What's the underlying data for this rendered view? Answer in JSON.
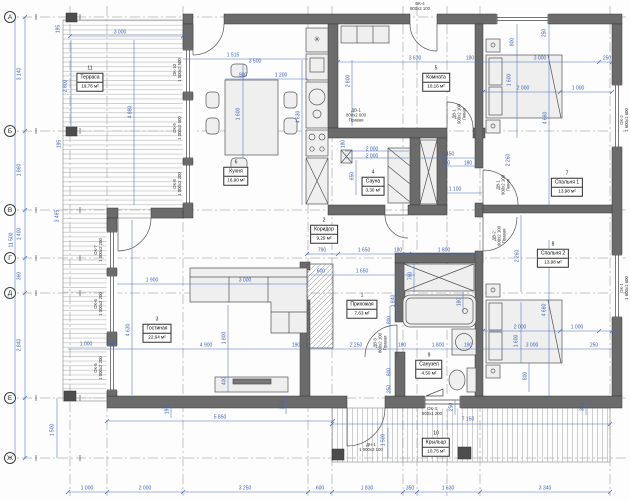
{
  "drawing_title": "План этажа",
  "axes": [
    {
      "label": "А",
      "y": 17
    },
    {
      "label": "Б",
      "y": 131
    },
    {
      "label": "В",
      "y": 210
    },
    {
      "label": "Г",
      "y": 258
    },
    {
      "label": "Д",
      "y": 293
    },
    {
      "label": "Е",
      "y": 398
    },
    {
      "label": "Ж",
      "y": 458
    }
  ],
  "rooms": [
    {
      "num": "11",
      "name": "Терраса",
      "area": "19,76 м²",
      "x": 90,
      "y": 80
    },
    {
      "num": "6",
      "name": "Кухня",
      "area": "16,90 м²",
      "x": 236,
      "y": 174
    },
    {
      "num": "5",
      "name": "Комната",
      "area": "10,16 м²",
      "x": 436,
      "y": 80
    },
    {
      "num": "4",
      "name": "Сауна",
      "area": "3,30 м²",
      "x": 373,
      "y": 184
    },
    {
      "num": "2",
      "name": "Коридор",
      "area": "9,29 м²",
      "x": 324,
      "y": 232
    },
    {
      "num": "1",
      "name": "Прихожая",
      "area": "7,63 м²",
      "x": 362,
      "y": 307
    },
    {
      "num": "3",
      "name": "Гостиная",
      "area": "22,64 м²",
      "x": 157,
      "y": 331
    },
    {
      "num": "9",
      "name": "Санузел",
      "area": "4,50 м²",
      "x": 429,
      "y": 367
    },
    {
      "num": "7",
      "name": "Спальня 1",
      "area": "13,98 м²",
      "x": 567,
      "y": 185
    },
    {
      "num": "8",
      "name": "Спальня 2",
      "area": "13,98 м²",
      "x": 553,
      "y": 256
    },
    {
      "num": "10",
      "name": "Крыльцо",
      "area": "10,75 м²",
      "x": 436,
      "y": 445
    }
  ],
  "marks": [
    {
      "lines": [
        "ВК-4",
        "800х2 100"
      ],
      "x": 420,
      "y": 6,
      "r": 0
    },
    {
      "lines": [
        "ДВ-1",
        "800х2 000",
        "Правая"
      ],
      "x": 356,
      "y": 115,
      "r": 0
    },
    {
      "lines": [
        "ДВ-1",
        "900х2 100",
        "Левая"
      ],
      "x": 459,
      "y": 114,
      "r": 1
    },
    {
      "lines": [
        "ДВ-1",
        "900х2 100",
        "Левая"
      ],
      "x": 503,
      "y": 185,
      "r": 1
    },
    {
      "lines": [
        "ДВ-2",
        "900х2 100",
        "Правая"
      ],
      "x": 499,
      "y": 236,
      "r": 1
    },
    {
      "lines": [
        "ДВ-3",
        "800х2 100",
        "Правая"
      ],
      "x": 380,
      "y": 343,
      "r": 1
    },
    {
      "lines": [
        "ДН-1",
        "1 000х2 100"
      ],
      "x": 371,
      "y": 447,
      "r": 0
    },
    {
      "lines": [
        "ОК-3",
        "600х1 200"
      ],
      "x": 432,
      "y": 411,
      "r": 0
    },
    {
      "lines": [
        "ОК-10",
        "1 000х2 500"
      ],
      "x": 177,
      "y": 70,
      "r": 1
    },
    {
      "lines": [
        "ОК-9",
        "1 000х2 500"
      ],
      "x": 177,
      "y": 128,
      "r": 1
    },
    {
      "lines": [
        "ОК-8",
        "1 000х2 200"
      ],
      "x": 177,
      "y": 184,
      "r": 1
    },
    {
      "lines": [
        "ОК-7",
        "1 000х2 200"
      ],
      "x": 98,
      "y": 250,
      "r": 1
    },
    {
      "lines": [
        "ОК-6",
        "1 000х2 200"
      ],
      "x": 98,
      "y": 304,
      "r": 1
    },
    {
      "lines": [
        "ОК-5",
        "1 000х2 200"
      ],
      "x": 98,
      "y": 368,
      "r": 1
    },
    {
      "lines": [
        "ОК-2",
        "1 600х1 600"
      ],
      "x": 624,
      "y": 120,
      "r": 1
    },
    {
      "lines": [
        "ОК-1",
        "1 600х1 600"
      ],
      "x": 624,
      "y": 288,
      "r": 1
    }
  ],
  "icons": [
    {
      "name": "fridge-snowflake-icon",
      "glyph": "✳",
      "x": 317,
      "y": 40
    }
  ],
  "dimensions": [
    {
      "t": "3 000",
      "x": 120,
      "y": 33,
      "r": 0
    },
    {
      "t": "195",
      "x": 59,
      "y": 29,
      "r": 1
    },
    {
      "t": "2 800",
      "x": 66,
      "y": 86,
      "r": 1
    },
    {
      "t": "4 880",
      "x": 131,
      "y": 112,
      "r": 1
    },
    {
      "t": "195",
      "x": 60,
      "y": 144,
      "r": 1
    },
    {
      "t": "3 465",
      "x": 58,
      "y": 216,
      "r": 1
    },
    {
      "t": "3 140",
      "x": 20,
      "y": 74,
      "r": 1
    },
    {
      "t": "1 860",
      "x": 20,
      "y": 170,
      "r": 1
    },
    {
      "t": "11 500",
      "x": 12,
      "y": 240,
      "r": 1
    },
    {
      "t": "1 400",
      "x": 20,
      "y": 234,
      "r": 1
    },
    {
      "t": "360",
      "x": 20,
      "y": 276,
      "r": 1
    },
    {
      "t": "2 840",
      "x": 20,
      "y": 345,
      "r": 1
    },
    {
      "t": "1 500",
      "x": 53,
      "y": 430,
      "r": 1
    },
    {
      "t": "1 515",
      "x": 233,
      "y": 56,
      "r": 0
    },
    {
      "t": "3 500",
      "x": 255,
      "y": 62,
      "r": 0
    },
    {
      "t": "900",
      "x": 243,
      "y": 76,
      "r": 0
    },
    {
      "t": "1 200",
      "x": 281,
      "y": 76,
      "r": 0
    },
    {
      "t": "1 600",
      "x": 239,
      "y": 114,
      "r": 1
    },
    {
      "t": "4 630",
      "x": 299,
      "y": 117,
      "r": 1
    },
    {
      "t": "2 800",
      "x": 349,
      "y": 81,
      "r": 1
    },
    {
      "t": "3 630",
      "x": 415,
      "y": 59,
      "r": 0
    },
    {
      "t": "180",
      "x": 470,
      "y": 59,
      "r": 0
    },
    {
      "t": "3 000",
      "x": 540,
      "y": 59,
      "r": 0
    },
    {
      "t": "250",
      "x": 607,
      "y": 59,
      "r": 0
    },
    {
      "t": "800",
      "x": 513,
      "y": 42,
      "r": 1
    },
    {
      "t": "250",
      "x": 545,
      "y": 33,
      "r": 1
    },
    {
      "t": "2 000",
      "x": 523,
      "y": 89,
      "r": 0
    },
    {
      "t": "1 000",
      "x": 578,
      "y": 89,
      "r": 0
    },
    {
      "t": "1 600",
      "x": 510,
      "y": 80,
      "r": 1
    },
    {
      "t": "4 660",
      "x": 546,
      "y": 118,
      "r": 1
    },
    {
      "t": "2 260",
      "x": 509,
      "y": 160,
      "r": 1
    },
    {
      "t": "1 450",
      "x": 448,
      "y": 155,
      "r": 0
    },
    {
      "t": "450",
      "x": 446,
      "y": 164,
      "r": 0
    },
    {
      "t": "180",
      "x": 468,
      "y": 164,
      "r": 0
    },
    {
      "t": "1 100",
      "x": 455,
      "y": 190,
      "r": 0
    },
    {
      "t": "2 000",
      "x": 372,
      "y": 150,
      "r": 0
    },
    {
      "t": "2 000",
      "x": 372,
      "y": 157,
      "r": 0
    },
    {
      "t": "650",
      "x": 353,
      "y": 176,
      "r": 1
    },
    {
      "t": "180",
      "x": 344,
      "y": 144,
      "r": 1
    },
    {
      "t": "790",
      "x": 322,
      "y": 251,
      "r": 0
    },
    {
      "t": "1 650",
      "x": 364,
      "y": 251,
      "r": 0
    },
    {
      "t": "180",
      "x": 398,
      "y": 251,
      "r": 0
    },
    {
      "t": "1 800",
      "x": 444,
      "y": 251,
      "r": 0
    },
    {
      "t": "600",
      "x": 321,
      "y": 272,
      "r": 0
    },
    {
      "t": "1 650",
      "x": 362,
      "y": 272,
      "r": 0
    },
    {
      "t": "760",
      "x": 411,
      "y": 276,
      "r": 1
    },
    {
      "t": "1 840",
      "x": 394,
      "y": 301,
      "r": 1
    },
    {
      "t": "180",
      "x": 460,
      "y": 302,
      "r": 1
    },
    {
      "t": "2 250",
      "x": 356,
      "y": 346,
      "r": 0
    },
    {
      "t": "180",
      "x": 402,
      "y": 346,
      "r": 0
    },
    {
      "t": "1 800",
      "x": 438,
      "y": 346,
      "r": 0
    },
    {
      "t": "190",
      "x": 468,
      "y": 346,
      "r": 0
    },
    {
      "t": "800",
      "x": 390,
      "y": 320,
      "r": 1
    },
    {
      "t": "800",
      "x": 390,
      "y": 372,
      "r": 1
    },
    {
      "t": "250",
      "x": 390,
      "y": 389,
      "r": 1
    },
    {
      "t": "1 900",
      "x": 152,
      "y": 281,
      "r": 0
    },
    {
      "t": "3 000",
      "x": 245,
      "y": 281,
      "r": 0
    },
    {
      "t": "1 800",
      "x": 225,
      "y": 338,
      "r": 1
    },
    {
      "t": "400",
      "x": 225,
      "y": 381,
      "r": 1
    },
    {
      "t": "4 630",
      "x": 129,
      "y": 330,
      "r": 1
    },
    {
      "t": "4 900",
      "x": 206,
      "y": 346,
      "r": 0
    },
    {
      "t": "190",
      "x": 296,
      "y": 346,
      "r": 0
    },
    {
      "t": "1 000",
      "x": 86,
      "y": 345,
      "r": 0
    },
    {
      "t": "750",
      "x": 111,
      "y": 345,
      "r": 0
    },
    {
      "t": "2 000",
      "x": 520,
      "y": 328,
      "r": 0
    },
    {
      "t": "1 000",
      "x": 577,
      "y": 328,
      "r": 0
    },
    {
      "t": "1 600",
      "x": 517,
      "y": 341,
      "r": 1
    },
    {
      "t": "3 000",
      "x": 532,
      "y": 346,
      "r": 0
    },
    {
      "t": "250",
      "x": 594,
      "y": 346,
      "r": 0
    },
    {
      "t": "800",
      "x": 526,
      "y": 376,
      "r": 1
    },
    {
      "t": "4 660",
      "x": 545,
      "y": 310,
      "r": 1
    },
    {
      "t": "2 260",
      "x": 518,
      "y": 256,
      "r": 1
    },
    {
      "t": "5 850",
      "x": 220,
      "y": 418,
      "r": 0
    },
    {
      "t": "7 150",
      "x": 468,
      "y": 420,
      "r": 0
    },
    {
      "t": "1 500",
      "x": 384,
      "y": 440,
      "r": 1
    },
    {
      "t": "250",
      "x": 283,
      "y": 405,
      "r": 1
    },
    {
      "t": "250",
      "x": 452,
      "y": 407,
      "r": 1
    },
    {
      "t": "350",
      "x": 583,
      "y": 407,
      "r": 1
    },
    {
      "t": "195",
      "x": 168,
      "y": 410,
      "r": 1
    },
    {
      "t": "1 000",
      "x": 87,
      "y": 489,
      "r": 0
    },
    {
      "t": "2 000",
      "x": 145,
      "y": 489,
      "r": 0
    },
    {
      "t": "3 250",
      "x": 245,
      "y": 489,
      "r": 0
    },
    {
      "t": "600",
      "x": 320,
      "y": 489,
      "r": 0
    },
    {
      "t": "1 830",
      "x": 367,
      "y": 489,
      "r": 0
    },
    {
      "t": "350",
      "x": 410,
      "y": 489,
      "r": 0
    },
    {
      "t": "1 630",
      "x": 448,
      "y": 489,
      "r": 0
    },
    {
      "t": "3 340",
      "x": 545,
      "y": 489,
      "r": 0
    }
  ],
  "colors": {
    "wall": "#6b6b6b",
    "dim": "#4a6fbe",
    "hatch": "#b5b5b5"
  }
}
